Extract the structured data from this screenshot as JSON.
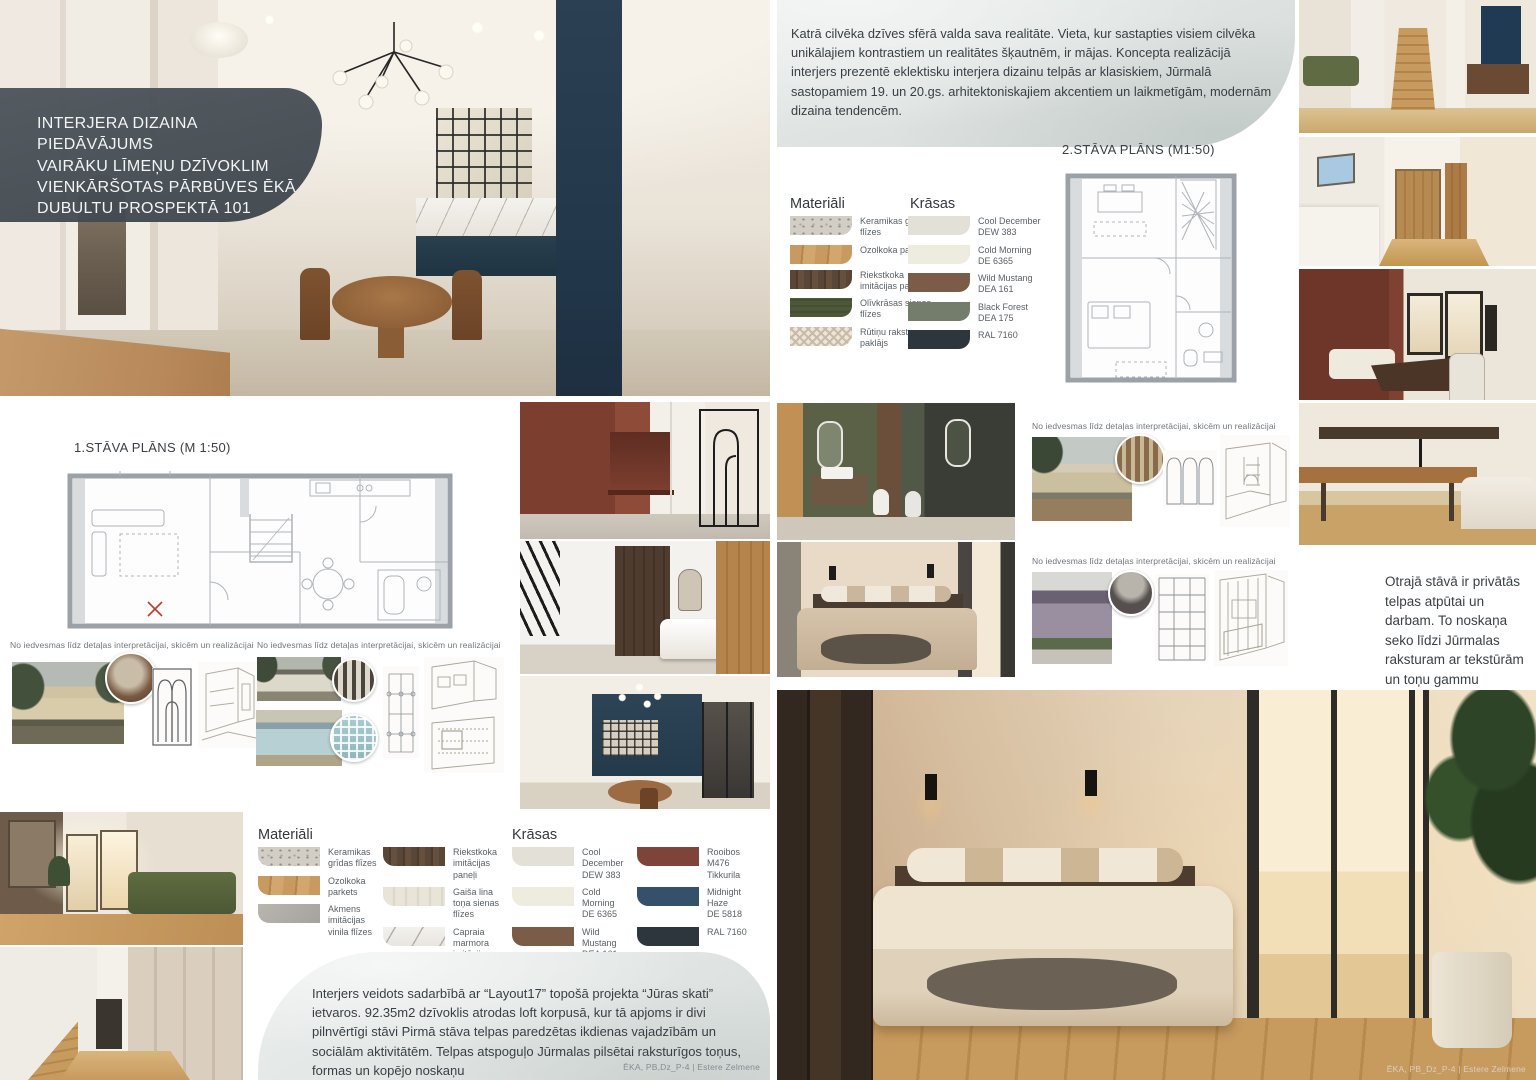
{
  "header": {
    "title_lines": [
      "INTERJERA DIZAINA PIEDĀVĀJUMS",
      "VAIRĀKU LĪMEŅU DZĪVOKLIM",
      "VIENKĀRŠOTAS PĀRBŪVES ĒKĀ",
      "DUBULTU PROSPEKTĀ 101"
    ]
  },
  "intro_paragraph": "Katrā cilvēka dzīves sfērā valda sava realitāte. Vieta, kur sastapties visiem cilvēka unikālajiem kontrastiem un realitātes šķautnēm, ir mājas. Koncepta realizācijā  interjers prezentē eklektisku interjera dizainu telpās ar klasiskiem, Jūrmalā sastopamiem 19. un 20.gs. arhitektoniskajiem akcentiem un laikmetīgām, modernām dizaina tendencēm.",
  "plans": {
    "first_floor_label": "1.STĀVA PLĀNS (M 1:50)",
    "second_floor_label": "2.STĀVA PLĀNS (M1:50)"
  },
  "sketch_caption": "No iedvesmas līdz detaļas interpretācijai, skicēm un realizācijai",
  "legend_upper": {
    "materials_title": "Materiāli",
    "materials": [
      {
        "name": "Keramikas grīdas flīzes"
      },
      {
        "name": "Ozolkoka parkets"
      },
      {
        "name": "Riekstkoka imitācijas paneļi"
      },
      {
        "name": "Olīvkrāsas sienas flīzes"
      },
      {
        "name": "Rūtiņu raksta paklājs"
      }
    ],
    "colors_title": "Krāsas",
    "colors": [
      {
        "name": "Cool December",
        "code": "DEW 383",
        "hex": "#e2e0d7"
      },
      {
        "name": "Cold Morning",
        "code": "DE 6365",
        "hex": "#edecdf"
      },
      {
        "name": "Wild Mustang",
        "code": "DEA 161",
        "hex": "#7b5c48"
      },
      {
        "name": "Black Forest",
        "code": "DEA 175",
        "hex": "#747c6b"
      },
      {
        "name": "RAL 7160",
        "code": "",
        "hex": "#2d353d"
      }
    ]
  },
  "legend_lower": {
    "materials_title": "Materiāli",
    "materials": [
      {
        "name": "Keramikas grīdas flīzes"
      },
      {
        "name": "Ozolkoka parkets"
      },
      {
        "name": "Akmens imitācijas vinila flīzes"
      },
      {
        "name": "Riekstkoka imitācijas paneļi"
      },
      {
        "name": "Gaiša lina toņa sienas flīzes"
      },
      {
        "name": "Capraia marmora imitācijas keramika"
      }
    ],
    "colors_title": "Krāsas",
    "colors": [
      {
        "name": "Cool December",
        "code": "DEW 383",
        "hex": "#e2e0d7"
      },
      {
        "name": "Cold Morning",
        "code": "DE 6365",
        "hex": "#edecdf"
      },
      {
        "name": "Wild Mustang",
        "code": "DEA 161",
        "hex": "#7b5c48"
      },
      {
        "name": "Rooibos",
        "code": "M476 Tikkurila",
        "hex": "#7e443a"
      },
      {
        "name": "Midnight Haze",
        "code": "DE 5818",
        "hex": "#35506b"
      },
      {
        "name": "RAL 7160",
        "code": "",
        "hex": "#2d353d"
      }
    ]
  },
  "second_floor_note": "Otrajā stāvā ir privātās telpas  atpūtai un darbam. To noskaņa seko līdzi Jūrmalas raksturam ar tekstūrām un toņu gammu",
  "outro_paragraph": "Interjers veidots sadarbībā ar “Layout17” topošā projekta “Jūras skati” ietvaros. 92.35m2 dzīvoklis atrodas loft korpusā, kur tā apjoms ir divi pilnvērtīgi stāvi Pirmā stāva telpas paredzētas ikdienas vajadzībām un sociālām aktivitātēm. Telpas atspoguļo Jūrmalas pilsētai raksturīgos toņus, formas un kopējo noskaņu",
  "credits": {
    "left": "ĒKA, PB,Dz_P-4 | Estere Zelmene",
    "right": "ĒKA, PB_Dz_P-4 | Estere Zelmene"
  }
}
